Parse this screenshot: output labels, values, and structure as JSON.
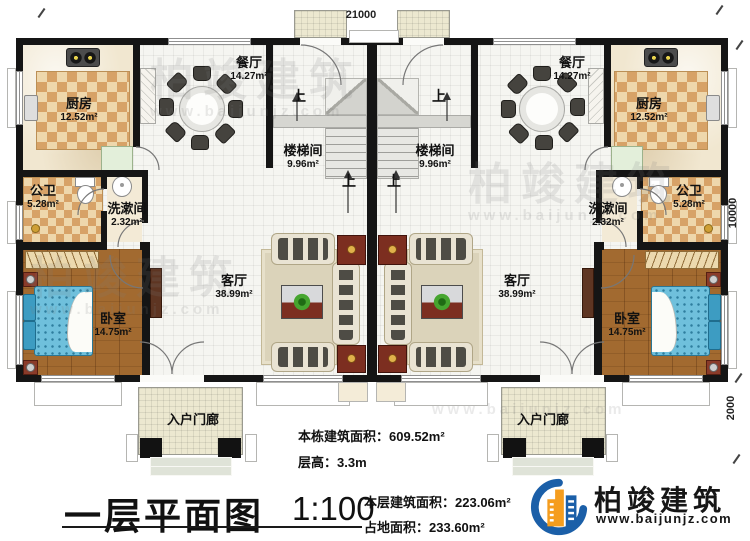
{
  "dimensions": {
    "top_width": "21000",
    "right_height": "10000",
    "right_porch_depth": "2000"
  },
  "rooms": {
    "kitchen": {
      "name": "厨房",
      "area": "12.52m²"
    },
    "dining": {
      "name": "餐厅",
      "area": "14.27m²"
    },
    "stairwell": {
      "name": "楼梯间",
      "area": "9.96m²"
    },
    "bathroom": {
      "name": "公卫",
      "area": "5.28m²"
    },
    "washroom": {
      "name": "洗漱间",
      "area": "2.32m²"
    },
    "living": {
      "name": "客厅",
      "area": "38.99m²"
    },
    "bedroom": {
      "name": "卧室",
      "area": "14.75m²"
    },
    "entry_porch": {
      "name": "入户门廊"
    }
  },
  "stairs": {
    "up": "上"
  },
  "title_block": {
    "title": "一层平面图",
    "scale": "1:100",
    "stats": [
      {
        "label": "本栋建筑面积：",
        "value": "609.52m²"
      },
      {
        "label": "层高：",
        "value": "3.3m"
      },
      {
        "label": "本层建筑面积：",
        "value": "223.06m²"
      },
      {
        "label": "占地面积：",
        "value": "233.60m²"
      }
    ]
  },
  "brand": {
    "name": "柏竣建筑",
    "website": "www.baijunjz.com"
  },
  "watermark": {
    "name": "柏竣建筑",
    "website": "www.baijunjz.com"
  },
  "colors": {
    "accent_blue": "#1b5fa8",
    "accent_orange": "#f59d1e",
    "wall": "#151515",
    "checker_dark": "#d7a267",
    "checker_light": "#eed7ac",
    "wood": "#a26a30",
    "bed_blue": "#6fc0dc",
    "maroon": "#7c2e20"
  }
}
